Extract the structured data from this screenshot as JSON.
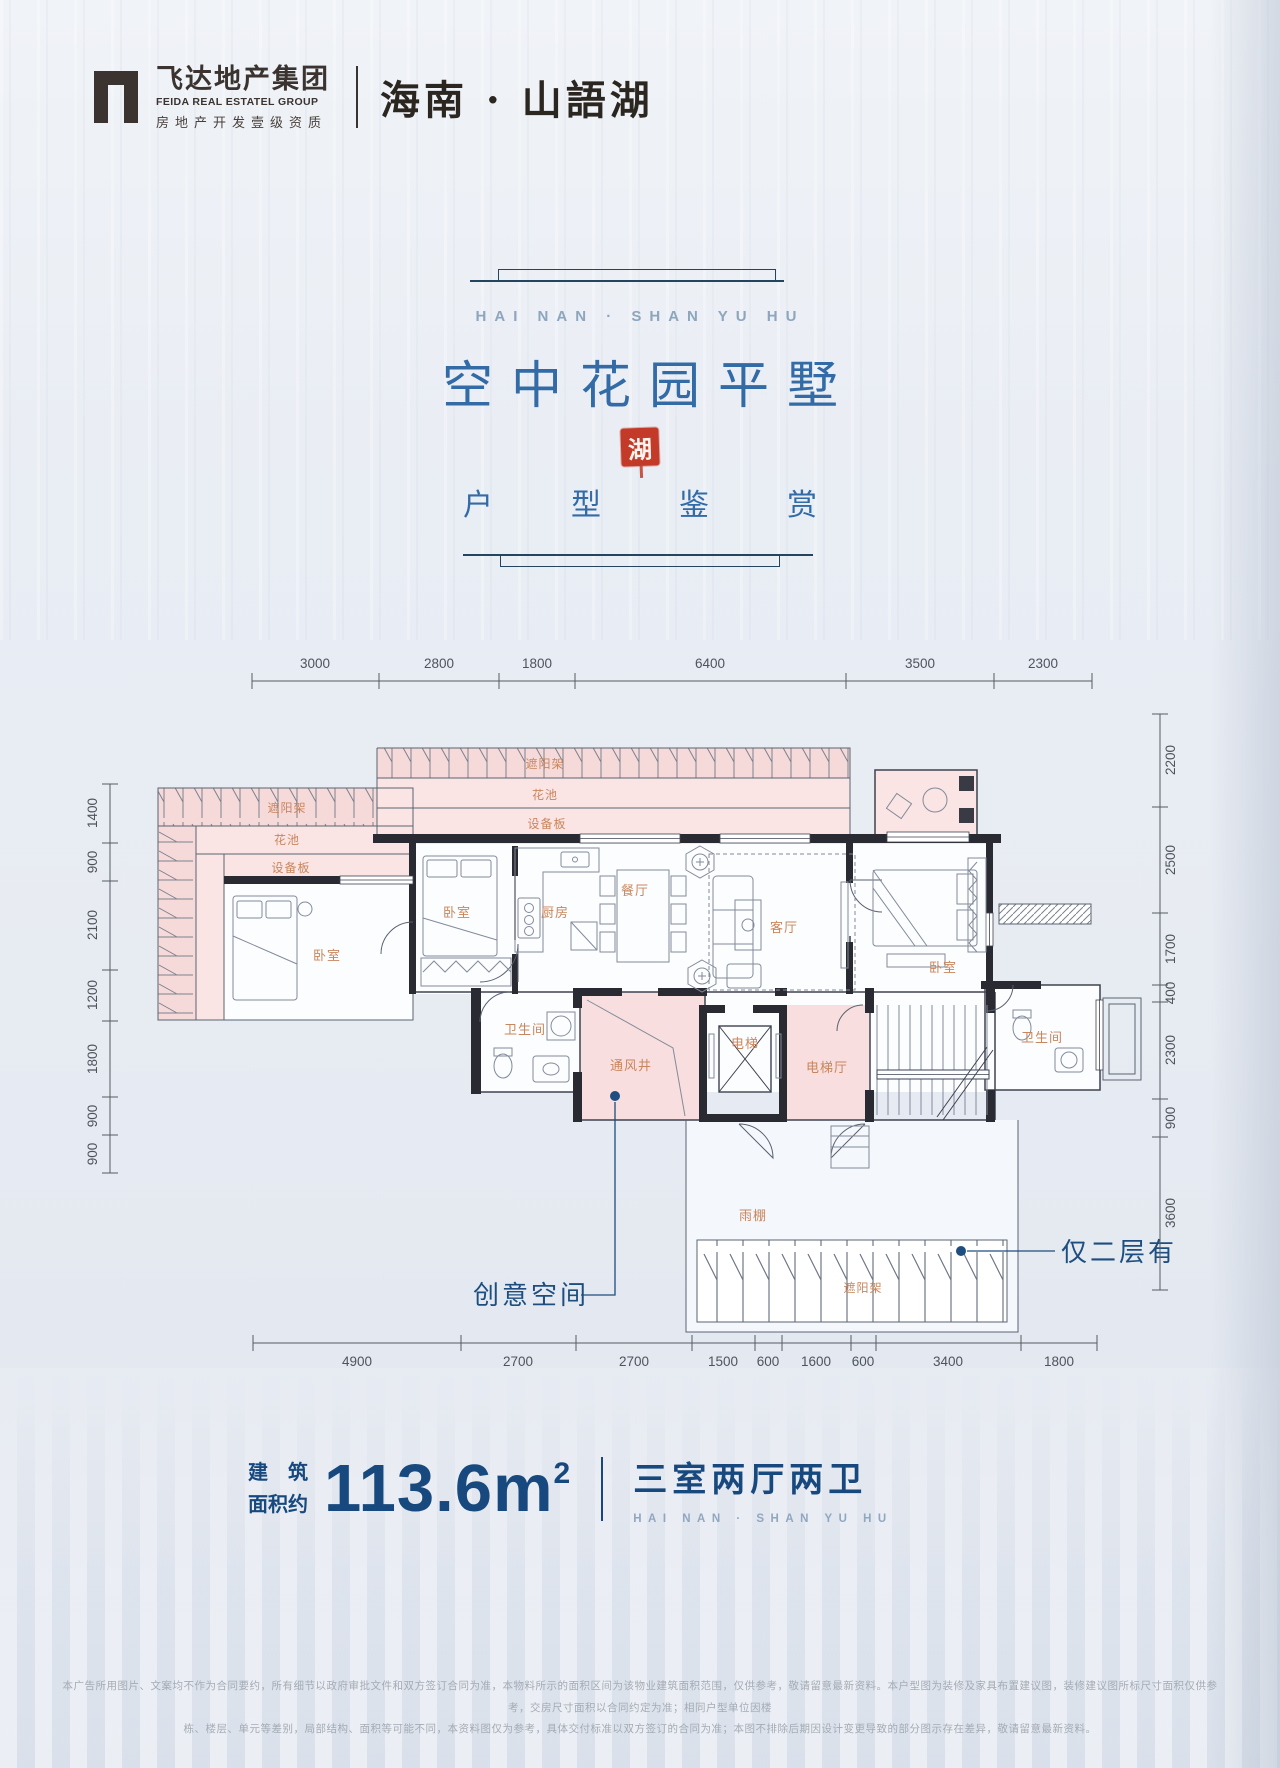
{
  "header": {
    "logo_cn": "飞达地产集团",
    "logo_en": "FEIDA REAL ESTATEL GROUP",
    "logo_sub": "房地产开发壹级资质",
    "project_name": "海南 · 山語湖"
  },
  "title_block": {
    "en_line": "HAI NAN · SHAN YU HU",
    "main_title": "空中花园平墅",
    "seal_char": "湖",
    "sub_title": "户型鉴赏"
  },
  "plan": {
    "dims_top": [
      "3000",
      "2800",
      "1800",
      "6400",
      "3500",
      "2300"
    ],
    "dims_bottom": [
      "4900",
      "2700",
      "2700",
      "1500",
      "600",
      "1600",
      "600",
      "3400",
      "1800"
    ],
    "dims_left": [
      "1400",
      "900",
      "2100",
      "1200",
      "1800",
      "900",
      "900"
    ],
    "dims_right": [
      "2200",
      "2500",
      "1700",
      "400",
      "2300",
      "900",
      "3600"
    ],
    "labels": {
      "shade_main": "遮阳架",
      "flower_main": "花池",
      "equip_main": "设备板",
      "shade_garden": "遮阳架",
      "flower_garden": "花池",
      "equip_garden": "设备板",
      "bedroom_garden": "卧室",
      "bedroom_mid": "卧室",
      "kitchen": "厨房",
      "dining": "餐厅",
      "living": "客厅",
      "bedroom_right": "卧室",
      "bath_left": "卫生间",
      "vent_shaft": "通风井",
      "elevator": "电梯",
      "elevator_hall": "电梯厅",
      "bath_right": "卫生间",
      "rain_canopy": "雨棚",
      "shade_bottom": "遮阳架"
    },
    "annotations": {
      "creative_space": "创意空间",
      "second_floor_only": "仅二层有"
    }
  },
  "footer": {
    "area_label_line1": "建　筑",
    "area_label_line2": "面积约",
    "area_value": "113.6m",
    "area_sup": "2",
    "layout_text": "三室两厅两卫",
    "layout_sub": "HAI NAN · SHAN YU HU"
  },
  "disclaimer": {
    "line1": "本广告所用图片、文案均不作为合同要约，所有细节以政府审批文件和双方签订合同为准，本物料所示的面积区间为该物业建筑面积范围，仅供参考，敬请留意最新资料。本户型图为装修及家具布置建议图，装修建议图所标尺寸面积仅供参考，交房尺寸面积以合同约定为准；相同户型单位因楼",
    "line2": "栋、楼层、单元等差别，局部结构、面积等可能不同，本资料图仅为参考，具体交付标准以双方签订的合同为准；本图不排除后期因设计变更导致的部分图示存在差异，敬请留意最新资料。"
  },
  "colors": {
    "title_blue": "#336ba6",
    "navy": "#17497e",
    "label_orange": "#c9865c",
    "seal_red": "#c43a28",
    "wall_dark": "#2a2a32",
    "pink_zone": "#f8dede",
    "dim_gray": "#4e545c"
  }
}
